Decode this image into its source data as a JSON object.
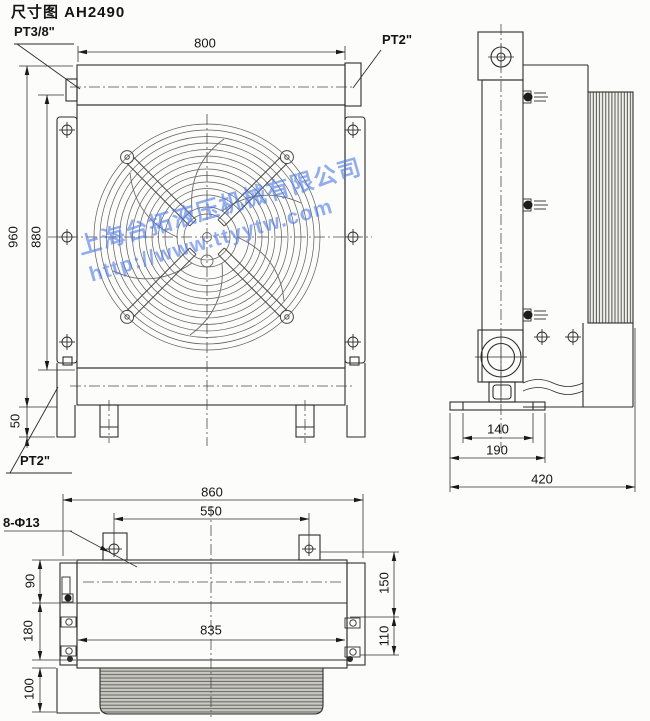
{
  "title": "尺寸图 AH2490",
  "watermark": {
    "company": "上海台拓液压机械有限公司",
    "url": "http://www.ttyytw.com",
    "color": "#4d79e6"
  },
  "views": {
    "front": {
      "ports": {
        "top_left": "PT3/8\"",
        "top_right": "PT2\"",
        "bottom_left": "PT2\""
      },
      "dims": {
        "width": "800",
        "height_total": "960",
        "height_body": "880",
        "base": "50"
      }
    },
    "side": {
      "dims": {
        "foot_holes": "140",
        "foot": "190",
        "depth": "420"
      }
    },
    "top": {
      "callout": "8-Φ13",
      "dims": {
        "width_total": "860",
        "tab_holes": "550",
        "offset_top": "90",
        "body": "180",
        "fan": "100",
        "length": "835",
        "right_upper": "150",
        "right_lower": "110"
      }
    }
  },
  "colors": {
    "line": "#2d2d2d",
    "paper": "#fcfcfa"
  }
}
